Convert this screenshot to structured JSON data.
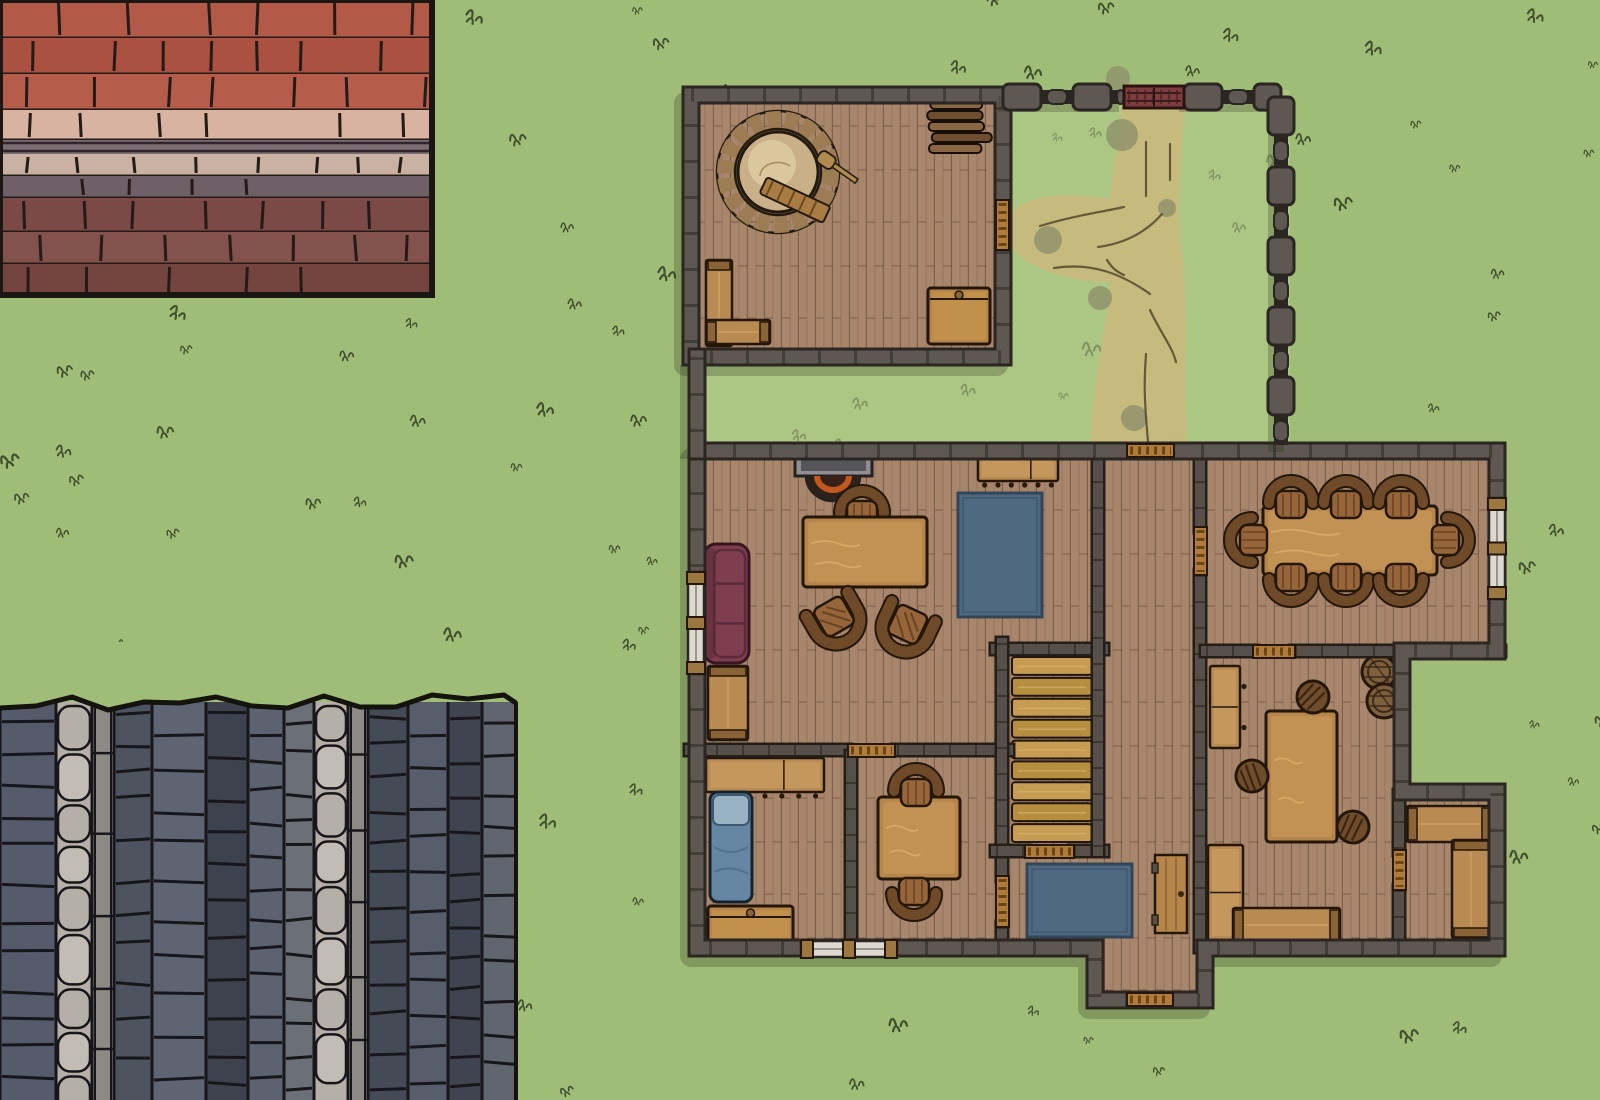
{
  "canvas": {
    "w": 1600,
    "h": 1100
  },
  "colors": {
    "grass": "#a0bd77",
    "grass_court": "#b6ce8e",
    "tuft": "#2f3c20",
    "path_sand": "#c7b97c",
    "path_patch": "#8f906a",
    "path_track": "#55482e",
    "wall": "#5f5751",
    "wall_edge": "#2b2622",
    "wall_joint": "#3b3530",
    "inwall": "#57504a",
    "floor": "#a8866c",
    "plank": "#5b4330",
    "stair": "#c59c52",
    "stair_alt": "#b58e3f",
    "table": "#b5854a",
    "table_light": "#d8ab67",
    "wood_edge": "#241709",
    "chair": "#96653a",
    "chair_back": "#6f4a28",
    "bench": "#b98a52",
    "bench_cap": "#8a6336",
    "stool": "#6f4c2a",
    "sofa": "#7e3e4f",
    "sofa_line": "#5c2b3b",
    "rug": "#4e6981",
    "rug_edge": "#32465a",
    "bed": "#6587a3",
    "bed_pillow": "#99b2c4",
    "oven_ring": "#9c7c52",
    "oven_dome": "#c9b089",
    "oven_dome_hi": "#e0cfa5",
    "barrel": "#7d5f3e",
    "fire": "#c2571f",
    "hearth": "#2d211a",
    "mantel": "#8f8f93",
    "mantel_in": "#55555a",
    "window_glass": "#ded9cf",
    "window_frame": "#9c7840",
    "threshold": "#b07c3c",
    "threshold_line": "#6b4515",
    "gate": "#7e3c3c",
    "roof_line": "#241a16",
    "slate_line": "#17161a"
  },
  "roof_red": {
    "x": 0,
    "y": 0,
    "w": 432,
    "h": 295,
    "bands": [
      {
        "h": 38,
        "c": "#b25948",
        "brick": 1
      },
      {
        "h": 36,
        "c": "#aa5142",
        "brick": 1
      },
      {
        "h": 36,
        "c": "#b55c4a",
        "brick": 1
      },
      {
        "h": 30,
        "c": "#d8b3a1",
        "brick": 1
      },
      {
        "h": 14,
        "c": "#7b6c72",
        "brick": 0
      },
      {
        "h": 22,
        "c": "#c9b2a2",
        "brick": 1
      },
      {
        "h": 22,
        "c": "#6f5f66",
        "brick": 1
      },
      {
        "h": 34,
        "c": "#7b4a47",
        "brick": 1
      },
      {
        "h": 32,
        "c": "#84524d",
        "brick": 1
      },
      {
        "h": 31,
        "c": "#74453f",
        "brick": 1
      }
    ]
  },
  "roof_slate": {
    "x": 0,
    "y": 702,
    "w": 516,
    "h": 398,
    "columns": [
      {
        "w": 56,
        "c": "#555b6b",
        "t": "col"
      },
      {
        "w": 36,
        "c": "#b5afa7",
        "t": "ridge"
      },
      {
        "w": 22,
        "c": "#8d8a86",
        "t": "pole"
      },
      {
        "w": 38,
        "c": "#4e5360",
        "t": "col"
      },
      {
        "w": 54,
        "c": "#5f6472",
        "t": "col"
      },
      {
        "w": 42,
        "c": "#3d424e",
        "t": "col"
      },
      {
        "w": 36,
        "c": "#5d6270",
        "t": "col"
      },
      {
        "w": 30,
        "c": "#6b7078",
        "t": "col"
      },
      {
        "w": 34,
        "c": "#b5afa7",
        "t": "ridge"
      },
      {
        "w": 20,
        "c": "#8d8a86",
        "t": "pole"
      },
      {
        "w": 40,
        "c": "#454a57",
        "t": "col"
      },
      {
        "w": 40,
        "c": "#575d6b",
        "t": "col"
      },
      {
        "w": 34,
        "c": "#3f4450",
        "t": "col"
      },
      {
        "w": 34,
        "c": "#60656f",
        "t": "col"
      }
    ]
  },
  "courtyard": {
    "grass": {
      "x": 695,
      "y": 90,
      "w": 595,
      "h": 358
    },
    "wall_segments": [
      [
        1003,
        97,
        1124,
        97
      ],
      [
        1184,
        97,
        1281,
        97
      ],
      [
        1281,
        97,
        1281,
        445
      ]
    ],
    "gate": {
      "x": 1124,
      "y": 86,
      "w": 60,
      "h": 22
    },
    "path_blobs": [
      "M1124,84 C1120,150 1104,190 1110,250 C1115,305 1092,370 1090,450 L1188,450 C1182,380 1190,305 1182,252 C1175,205 1183,140 1187,84 Z",
      "M1115,200 C1062,190 1014,196 1006,222 C999,249 1036,280 1114,283 Z"
    ],
    "path_patches": [
      [
        1122,
        135,
        16
      ],
      [
        1048,
        240,
        14
      ],
      [
        1100,
        298,
        12
      ],
      [
        1134,
        418,
        13
      ],
      [
        1167,
        208,
        9
      ],
      [
        1118,
        78,
        12
      ]
    ],
    "path_tracks": [
      "M1146,142 V196",
      "M1170,144 V180",
      "M1040,226 C1072,216 1102,212 1124,207",
      "M1054,268 C1092,262 1122,274 1150,294",
      "M1098,247 C1128,243 1148,230 1162,214",
      "M1150,310 C1160,332 1172,346 1176,362",
      "M1146,354 C1143,392 1146,416 1148,442",
      "M1107,260 C1112,268 1117,272 1124,275"
    ]
  },
  "architecture": {
    "floors": [
      {
        "x": 684,
        "y": 88,
        "w": 326,
        "h": 276
      },
      {
        "x": 690,
        "y": 444,
        "w": 814,
        "h": 511
      },
      {
        "x": 1088,
        "y": 944,
        "w": 122,
        "h": 62
      }
    ],
    "notch": {
      "x": 1409,
      "y": 657,
      "w": 95,
      "h": 131
    },
    "exterior": [
      "M697,451 H1497 V651 H1402 V792 H1497 V948 H1205 V1000 H1095 V948 H697 Z",
      "M691,95 H1003 V357 H691 Z",
      "M697,357 V451"
    ],
    "interior": [
      "M690,750 H846",
      "M897,750 H1008",
      "M851,756 V947",
      "M996,649 H1103",
      "M1002,643 V876",
      "M1002,927 V947",
      "M996,851 H1025",
      "M1074,851 H1103",
      "M1098,455 V851",
      "M1200,455 V527",
      "M1200,575 V947",
      "M1206,651 H1253",
      "M1295,651 H1500",
      "M1399,795 V850",
      "M1399,890 V947"
    ],
    "stairs": {
      "x": 1012,
      "y": 656,
      "w": 80,
      "h": 188,
      "steps": 9
    },
    "doors": [
      {
        "name": "front-door",
        "x": 1127,
        "y": 444,
        "w": 47,
        "h": 13
      },
      {
        "name": "oven-room-door",
        "x": 996,
        "y": 200,
        "w": 13,
        "h": 50
      },
      {
        "name": "dining-door",
        "x": 1194,
        "y": 527,
        "w": 13,
        "h": 48
      },
      {
        "name": "dining-workshop-door",
        "x": 1253,
        "y": 645,
        "w": 42,
        "h": 13
      },
      {
        "name": "bedroom-door",
        "x": 848,
        "y": 744,
        "w": 47,
        "h": 13
      },
      {
        "name": "stairs-door",
        "x": 1025,
        "y": 845,
        "w": 49,
        "h": 13
      },
      {
        "name": "study-door",
        "x": 996,
        "y": 876,
        "w": 13,
        "h": 51
      },
      {
        "name": "store-room-door",
        "x": 1393,
        "y": 850,
        "w": 13,
        "h": 40
      },
      {
        "name": "porch-door",
        "x": 1127,
        "y": 993,
        "w": 46,
        "h": 13
      }
    ],
    "windows": [
      {
        "name": "window",
        "x": 688,
        "y": 572,
        "w": 16,
        "h": 102
      },
      {
        "name": "window",
        "x": 801,
        "y": 941,
        "w": 96,
        "h": 16
      },
      {
        "name": "window",
        "x": 1489,
        "y": 498,
        "w": 16,
        "h": 101
      }
    ]
  },
  "scene": {
    "rooms": [
      {
        "name": "oven-room",
        "items": [
          "stone-oven",
          "firewood-stack",
          "corner-bench",
          "storage-chest"
        ]
      },
      {
        "name": "courtyard",
        "items": [
          "dirt-path",
          "stone-wall",
          "gate"
        ]
      },
      {
        "name": "living-room",
        "items": [
          "fireplace",
          "table",
          "chair",
          "armchair",
          "armchair",
          "sofa",
          "side-bench",
          "sideboard",
          "large-rug"
        ]
      },
      {
        "name": "bedroom",
        "items": [
          "counter",
          "bed",
          "chest"
        ]
      },
      {
        "name": "study",
        "items": [
          "square-table",
          "chair",
          "chair"
        ]
      },
      {
        "name": "hall",
        "items": [
          "staircase",
          "small-rug",
          "open-door"
        ]
      },
      {
        "name": "dining-room",
        "items": [
          "long-table",
          "eight-chairs"
        ]
      },
      {
        "name": "workshop",
        "items": [
          "sideboard",
          "work-table",
          "stools",
          "barrels",
          "cabinet",
          "bench"
        ]
      },
      {
        "name": "store-room",
        "items": [
          "bench",
          "bench"
        ]
      },
      {
        "name": "porch",
        "items": [
          "door-threshold"
        ]
      }
    ],
    "furniture": [
      {
        "type": "oven",
        "name": "stone-oven",
        "cx": 778,
        "cy": 172
      },
      {
        "type": "firewood",
        "name": "firewood-stack",
        "x": 926,
        "y": 100,
        "w": 68,
        "h": 54
      },
      {
        "type": "bench",
        "name": "corner-bench-vertical",
        "x": 706,
        "y": 260,
        "w": 26,
        "h": 86
      },
      {
        "type": "bench",
        "name": "corner-bench-horizontal",
        "x": 706,
        "y": 320,
        "w": 64,
        "h": 24
      },
      {
        "type": "chest",
        "name": "storage-chest",
        "x": 928,
        "y": 288,
        "w": 62,
        "h": 56
      },
      {
        "type": "fireplace",
        "name": "fireplace",
        "x": 795,
        "y": 446
      },
      {
        "type": "chair",
        "name": "chair",
        "cx": 862,
        "cy": 510,
        "rot": 0
      },
      {
        "type": "table",
        "name": "living-room-table",
        "x": 803,
        "y": 517,
        "w": 124,
        "h": 70
      },
      {
        "type": "armchair",
        "name": "armchair",
        "cx": 836,
        "cy": 620,
        "rot": 150
      },
      {
        "type": "armchair",
        "name": "armchair",
        "cx": 906,
        "cy": 628,
        "rot": 205
      },
      {
        "type": "sofa",
        "name": "sofa",
        "x": 704,
        "y": 544,
        "w": 45,
        "h": 119
      },
      {
        "type": "bench",
        "name": "side-bench",
        "x": 708,
        "y": 666,
        "w": 40,
        "h": 74
      },
      {
        "type": "counter",
        "name": "sideboard",
        "x": 978,
        "y": 455,
        "w": 80,
        "h": 26,
        "knobs": 6,
        "side": "s"
      },
      {
        "type": "rug",
        "name": "large-rug",
        "x": 958,
        "y": 493,
        "w": 84,
        "h": 124
      },
      {
        "type": "counter",
        "name": "bedroom-counter",
        "x": 706,
        "y": 758,
        "w": 118,
        "h": 34,
        "knobs": 7,
        "side": "s"
      },
      {
        "type": "bed",
        "name": "bed",
        "x": 710,
        "y": 792,
        "w": 42,
        "h": 110
      },
      {
        "type": "chest",
        "name": "bedroom-chest",
        "x": 708,
        "y": 906,
        "w": 85,
        "h": 36
      },
      {
        "type": "table",
        "name": "study-table",
        "x": 878,
        "y": 797,
        "w": 82,
        "h": 82
      },
      {
        "type": "chair",
        "name": "chair",
        "cx": 916,
        "cy": 788,
        "rot": 0
      },
      {
        "type": "chair",
        "name": "chair",
        "cx": 914,
        "cy": 896,
        "rot": 180
      },
      {
        "type": "rug",
        "name": "small-rug",
        "x": 1027,
        "y": 864,
        "w": 105,
        "h": 73
      },
      {
        "type": "doorleaf",
        "name": "open-door",
        "x": 1155,
        "y": 855,
        "w": 32,
        "h": 78
      },
      {
        "type": "table",
        "name": "dining-table",
        "x": 1263,
        "y": 506,
        "w": 174,
        "h": 69
      },
      {
        "type": "chair",
        "name": "dining-chair",
        "cx": 1291,
        "cy": 500,
        "rot": 0
      },
      {
        "type": "chair",
        "name": "dining-chair",
        "cx": 1346,
        "cy": 500,
        "rot": 0
      },
      {
        "type": "chair",
        "name": "dining-chair",
        "cx": 1401,
        "cy": 500,
        "rot": 0
      },
      {
        "type": "chair",
        "name": "dining-chair",
        "cx": 1291,
        "cy": 582,
        "rot": 180
      },
      {
        "type": "chair",
        "name": "dining-chair",
        "cx": 1346,
        "cy": 582,
        "rot": 180
      },
      {
        "type": "chair",
        "name": "dining-chair",
        "cx": 1401,
        "cy": 582,
        "rot": 180
      },
      {
        "type": "chair",
        "name": "dining-chair",
        "cx": 1249,
        "cy": 540,
        "rot": 270
      },
      {
        "type": "chair",
        "name": "dining-chair",
        "cx": 1450,
        "cy": 540,
        "rot": 90
      },
      {
        "type": "counter",
        "name": "workshop-sideboard",
        "x": 1210,
        "y": 666,
        "w": 30,
        "h": 82,
        "knobs": 2,
        "side": "e"
      },
      {
        "type": "table",
        "name": "work-table",
        "x": 1266,
        "y": 711,
        "w": 71,
        "h": 131
      },
      {
        "type": "stool",
        "name": "stool",
        "cx": 1313,
        "cy": 697
      },
      {
        "type": "stool",
        "name": "stool",
        "cx": 1252,
        "cy": 776
      },
      {
        "type": "stool",
        "name": "stool",
        "cx": 1353,
        "cy": 827
      },
      {
        "type": "barrel",
        "name": "barrel",
        "cx": 1379,
        "cy": 672
      },
      {
        "type": "barrel",
        "name": "barrel",
        "cx": 1384,
        "cy": 701
      },
      {
        "type": "counter",
        "name": "workshop-cabinet",
        "x": 1208,
        "y": 845,
        "w": 35,
        "h": 95,
        "knobs": 2,
        "side": "w"
      },
      {
        "type": "bench",
        "name": "workshop-bench",
        "x": 1233,
        "y": 908,
        "w": 107,
        "h": 34
      },
      {
        "type": "bench",
        "name": "store-bench",
        "x": 1407,
        "y": 806,
        "w": 85,
        "h": 36
      },
      {
        "type": "bench",
        "name": "store-bench",
        "x": 1452,
        "y": 840,
        "w": 38,
        "h": 98
      }
    ]
  }
}
